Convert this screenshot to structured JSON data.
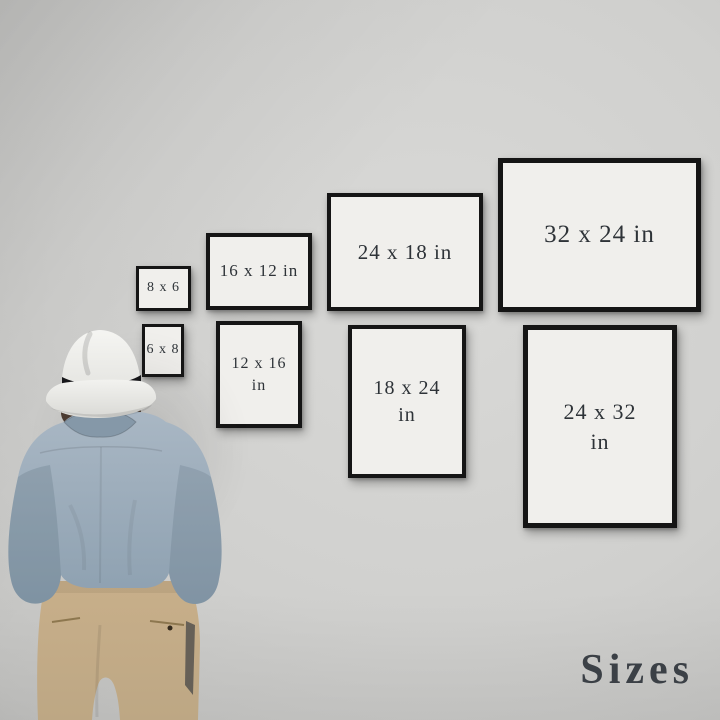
{
  "title": {
    "text": "Sizes"
  },
  "frames": [
    {
      "name": "8x6",
      "line1": "8 x 6",
      "line2": "",
      "orientation": "landscape"
    },
    {
      "name": "16x12",
      "line1": "16 x 12 in",
      "line2": "",
      "orientation": "landscape"
    },
    {
      "name": "24x18",
      "line1": "24 x 18 in",
      "line2": "",
      "orientation": "landscape"
    },
    {
      "name": "32x24",
      "line1": "32 x 24 in",
      "line2": "",
      "orientation": "landscape"
    },
    {
      "name": "6x8",
      "line1": "6 x 8",
      "line2": "",
      "orientation": "portrait"
    },
    {
      "name": "12x16",
      "line1": "12 x 16",
      "line2": "in",
      "orientation": "portrait"
    },
    {
      "name": "18x24",
      "line1": "18 x 24",
      "line2": "in",
      "orientation": "portrait"
    },
    {
      "name": "24x32",
      "line1": "24 x 32",
      "line2": "in",
      "orientation": "portrait"
    }
  ],
  "figure": {
    "description": "man wearing a white fedora, blue shirt and khaki trousers, seen from behind looking at the frames"
  },
  "colors": {
    "wall": "#d0d0ce",
    "wall_light": "#d9d9d7",
    "frame_border": "#151515",
    "frame_mat": "#f0efec",
    "label_text": "#2e3338",
    "title_text": "#3b4046",
    "hat": "#f2f2ef",
    "hat_band": "#17171a",
    "hair": "#4a3a30",
    "shirt": "#9cadbc",
    "shirt_shade": "#7d8fa0",
    "pants": "#c5ac87",
    "pants_shade": "#9f8866"
  }
}
